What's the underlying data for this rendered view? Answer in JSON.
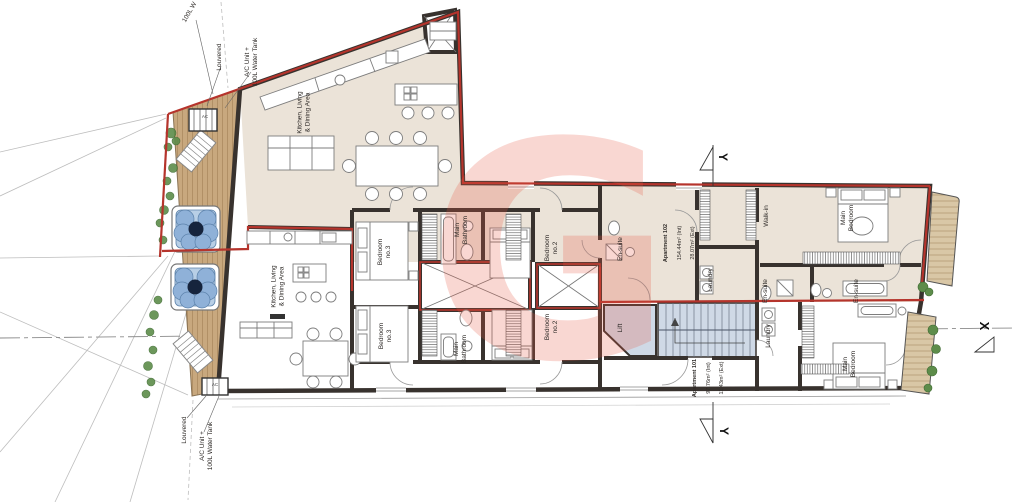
{
  "watermark": {
    "letter": "G",
    "color": "rgba(231,86,68,0.24)"
  },
  "colors": {
    "boundary_red": "#b5342c",
    "wall_dark": "#38322e",
    "apartment_floor": "#ebe3d8",
    "deck_wood": "#c8a87e",
    "stair_blue": "#cfd9e6",
    "hot_tub_blue": "#8fb1d8",
    "plant_green": "#5d8c4a"
  },
  "site": {
    "water_tank_top_partial": "100L W",
    "louvered_top": "Louvered",
    "ac_unit_top": "A/C Unit +\n100L Water Tank",
    "louvered_bottom": "Louvered",
    "ac_unit_bottom": "A/C Unit +\n100L Water Tank",
    "ac_box_top": "AC",
    "ac_box_bottom": "AC"
  },
  "apartments": [
    {
      "name": "Apartment 102",
      "internal": "154.44m² (Int)",
      "external": "28.07m² (Ext)"
    },
    {
      "name": "Apartment 101",
      "internal": "97.76m² (Int)",
      "external": "11.43m² (Ext)"
    }
  ],
  "rooms": {
    "kitchen_upper": "Kitchen, Living\n& Dining Area",
    "bedroom3_upper": "Bedroom\nno.3",
    "main_bathroom_upper": "Main\nBathroom",
    "bedroom2_upper": "Bedroom\nno.2",
    "ensuite_a": "En-suite",
    "laundry_upper": "Laundry",
    "walk_in": "Walk-in",
    "main_bedroom_upper": "Main\nBedroom",
    "ensuite_b": "En-suite",
    "ensuite_c": "En-suite",
    "kitchen_lower": "Kitchen, Living\n& Dining Area",
    "bedroom3_lower": "Bedroom\nno.3",
    "main_bathroom_lower": "Main\nBathroom",
    "bedroom2_lower": "Bedroom\nno.2",
    "lift": "Lift",
    "laundry_lower": "Laundry",
    "main_bedroom_lower": "Main\nBedroom"
  },
  "markers": {
    "section_y": "Y",
    "section_x": "X"
  }
}
